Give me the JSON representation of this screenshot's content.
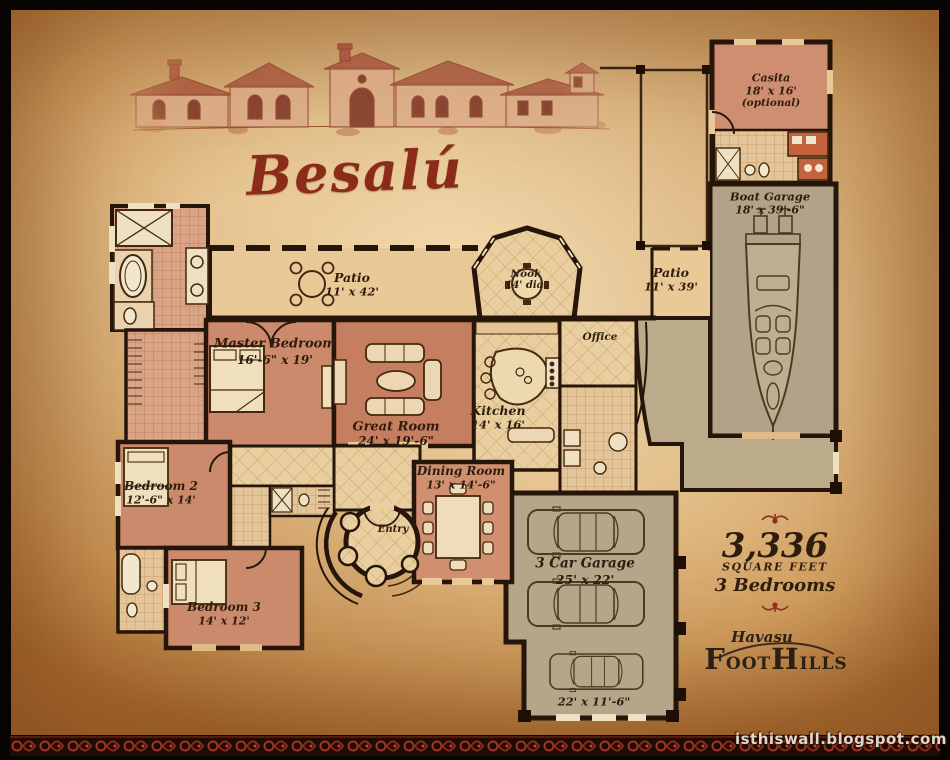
{
  "title": "Besalú",
  "watermark": "isthiswall.blogspot.com",
  "rooms": {
    "casita": {
      "name": "Casita",
      "dims": "18' x 16'",
      "note": "(optional)"
    },
    "boat_garage": {
      "name": "Boat Garage",
      "dims": "18' x 39'-6\""
    },
    "patio_west": {
      "name": "Patio",
      "dims": "11' x 42'"
    },
    "nook": {
      "name": "Nook",
      "dims": "14' dia."
    },
    "patio_east": {
      "name": "Patio",
      "dims": "11' x 39'"
    },
    "master_bedroom": {
      "name": "Master Bedroom",
      "dims": "16'-6\" x 19'"
    },
    "great_room": {
      "name": "Great Room",
      "dims": "24' x 19'-6\""
    },
    "kitchen": {
      "name": "Kitchen",
      "dims": "14' x 16'"
    },
    "office": {
      "name": "Office"
    },
    "dining_room": {
      "name": "Dining Room",
      "dims": "13' x 14'-6\""
    },
    "bedroom_2": {
      "name": "Bedroom 2",
      "dims": "12'-6\" x 14'"
    },
    "entry": {
      "name": "Entry"
    },
    "bedroom_3": {
      "name": "Bedroom 3",
      "dims": "14' x 12'"
    },
    "three_car_garage": {
      "name": "3 Car Garage",
      "dims": "25' x 22'"
    },
    "garage_bay": {
      "dims": "22' x 11'-6\""
    }
  },
  "stats": {
    "area": "3,336",
    "area_unit": "SQUARE FEET",
    "bedrooms": "3 Bedrooms"
  },
  "brand": {
    "script": "Havasu",
    "foot": "Foot",
    "hills": "Hills"
  },
  "colors": {
    "accent_red": "#8b2b1a",
    "wall": "#26150a",
    "parchment": "#e9c996",
    "room_pink": "#cc8a6c",
    "garage_gray": "#b4a588"
  }
}
